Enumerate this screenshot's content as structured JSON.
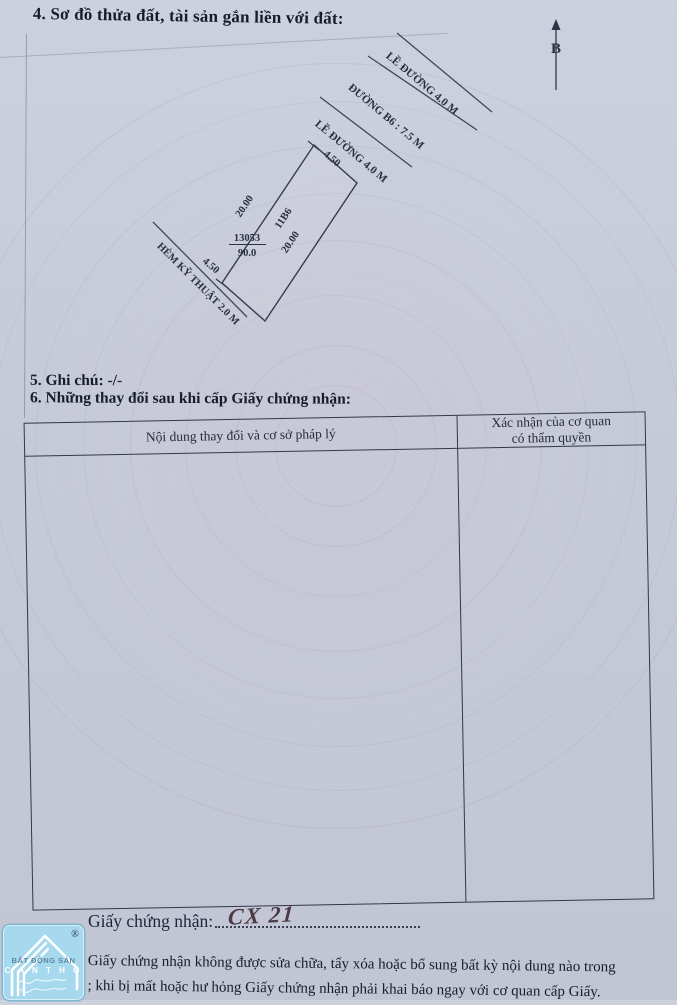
{
  "page": {
    "background_color": "#c7cbd9",
    "ink_color": "#1d2230",
    "handwriting_color": "#4e3a45",
    "logo_blue": "#a6d8ee"
  },
  "section4": {
    "heading": "4. Sơ đồ thửa đất, tài sản gắn liền với đất:"
  },
  "diagram": {
    "north_label": "B",
    "labels": {
      "road_top": "LỀ ĐƯỜNG 4.0 M",
      "road_name": "ĐƯỜNG B6 : 7.5 M",
      "road_bottom": "LỀ ĐƯỜNG 4.0 M",
      "alley": "HẺM KỸ THUẬT 2.0 M",
      "dim_front": "4.50",
      "dim_left": "20.00",
      "dim_right": "20.00",
      "dim_back": "4.50",
      "lot_code": "11B6",
      "parcel_number": "13053",
      "parcel_area": "90.0"
    }
  },
  "section5": {
    "heading": "5. Ghi chú: -/-"
  },
  "section6": {
    "heading": "6. Những thay đổi sau khi cấp Giấy chứng nhận:",
    "table": {
      "col1_header": "Nội dung thay đổi và cơ sở pháp lý",
      "col2_header_line1": "Xác nhận của cơ quan",
      "col2_header_line2": "có thẩm quyền"
    }
  },
  "certificate_line": {
    "label": "Giấy chứng nhận:",
    "value": "CX 21"
  },
  "footer": {
    "line1": "Giấy chứng nhận không được sửa chữa, tẩy xóa hoặc bổ sung bất kỳ nội dung nào trong",
    "line2": "; khi bị mất hoặc hư hỏng Giấy chứng nhận phải khai báo ngay với cơ quan cấp Giấy."
  },
  "logo": {
    "line1": "BẤT ĐỘNG SẢN",
    "line2": "C A N  T H O",
    "registered": "®"
  }
}
